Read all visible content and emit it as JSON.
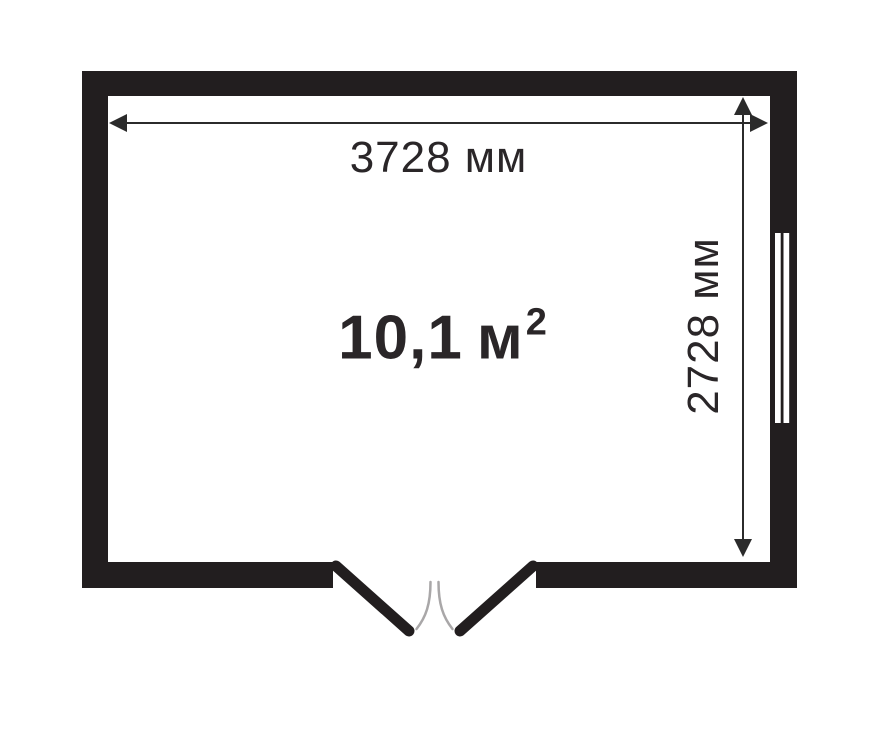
{
  "diagram": {
    "type": "floor-plan",
    "room": {
      "width_label": "3728 мм",
      "height_label": "2728 мм",
      "area_value": "10,1",
      "area_unit": "м",
      "area_exponent": "2",
      "width_mm": 3728,
      "height_mm": 2728,
      "area_m2": 10.1
    },
    "features": {
      "door": "double-door-bottom-wall",
      "window": "window-right-wall"
    },
    "colors": {
      "wall": "#221e1f",
      "background": "#ffffff",
      "dimension_line": "#2b2b2b",
      "text": "#2a2628",
      "door_swing_arc": "#a9a7a8"
    }
  }
}
